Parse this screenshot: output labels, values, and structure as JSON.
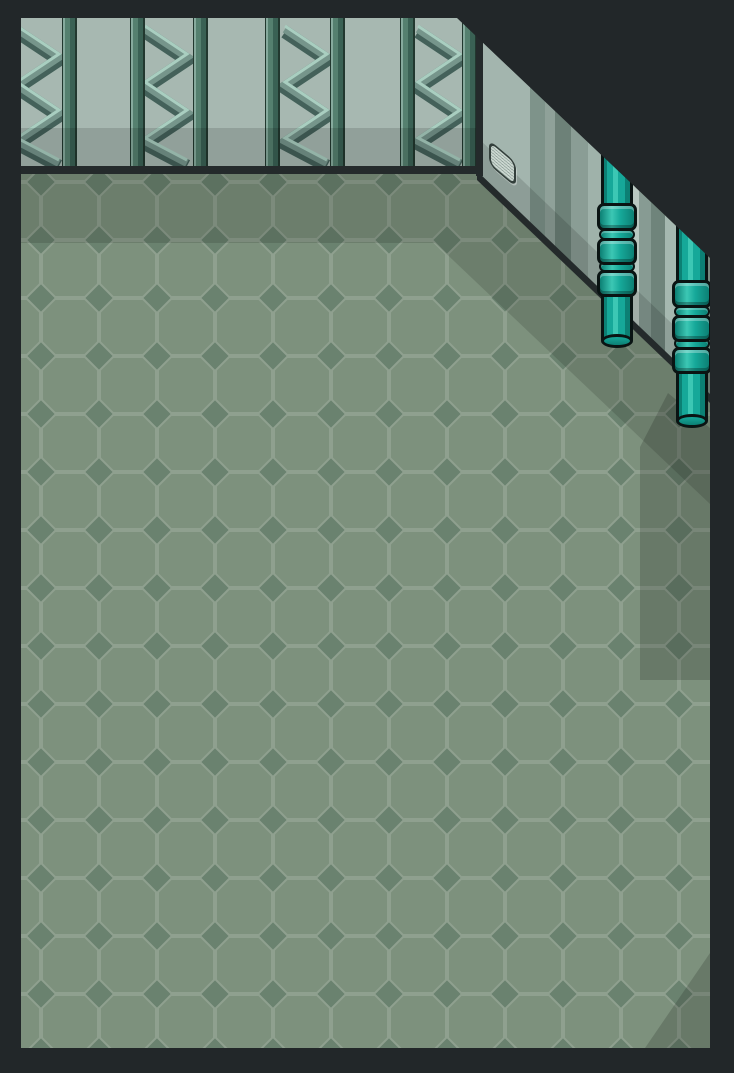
{
  "scene": {
    "title": "isometric warehouse room",
    "description": "empty metal-walled room with octagonal tiled floor, truss-braced top wall, diagonal panelled wall on the right, a wall vent and two segmented teal pipes",
    "floor": {
      "tile_shape": "octagon-with-diamond",
      "tile_size_px": 58,
      "shadow_bands": 3
    },
    "top_wall": {
      "truss_panels": 4,
      "columns": 7
    },
    "diagonal_wall": {
      "panel_stripes": 13,
      "vent_grates": 1
    },
    "pipes": {
      "count": 2,
      "couplings_per_pipe": 3,
      "rings_per_pipe": 2
    }
  },
  "colors": {
    "dark": "#222729",
    "floorBase": "#7d917d",
    "floorLine": "#8fa08f",
    "floorDiamond": "#6a826f",
    "shade": "rgba(0,0,0,0.13)",
    "shadeStrong": "rgba(0,0,0,0.16)",
    "wallFace": "#a7b8b1",
    "baseLine": "#242a2b",
    "colHi": "#86aa9d",
    "colMid": "#55806f",
    "colDark": "#3a6154",
    "colEdge": "#22382f",
    "trussHi": "#a9cec0",
    "trussMid": "#76958b",
    "trussDark": "#44615a",
    "pipeOutline": "#0a1413",
    "pipeDark": "#0c8074",
    "pipeMid": "#16a899",
    "pipeHi": "#3cc7b4",
    "ventFace": "#cbd7d0",
    "ventLine": "#93a49d",
    "ventBorder": "#333f3b",
    "wallStripes": [
      {
        "w": 53,
        "c": "#a3b5ae"
      },
      {
        "w": 15,
        "c": "#7e938a"
      },
      {
        "w": 10,
        "c": "#8fa199"
      },
      {
        "w": 16,
        "c": "#6d8178"
      },
      {
        "w": 17,
        "c": "#8a9d95"
      },
      {
        "w": 20,
        "c": "#9fb2aa"
      },
      {
        "w": 9,
        "c": "#5d726b"
      },
      {
        "w": 22,
        "c": "#b9c8c1"
      },
      {
        "w": 12,
        "c": "#879b93"
      },
      {
        "w": 14,
        "c": "#6f847b"
      },
      {
        "w": 24,
        "c": "#a5b8b0"
      },
      {
        "w": 14,
        "c": "#879b93"
      },
      {
        "w": 7,
        "c": "#77897f"
      }
    ]
  }
}
